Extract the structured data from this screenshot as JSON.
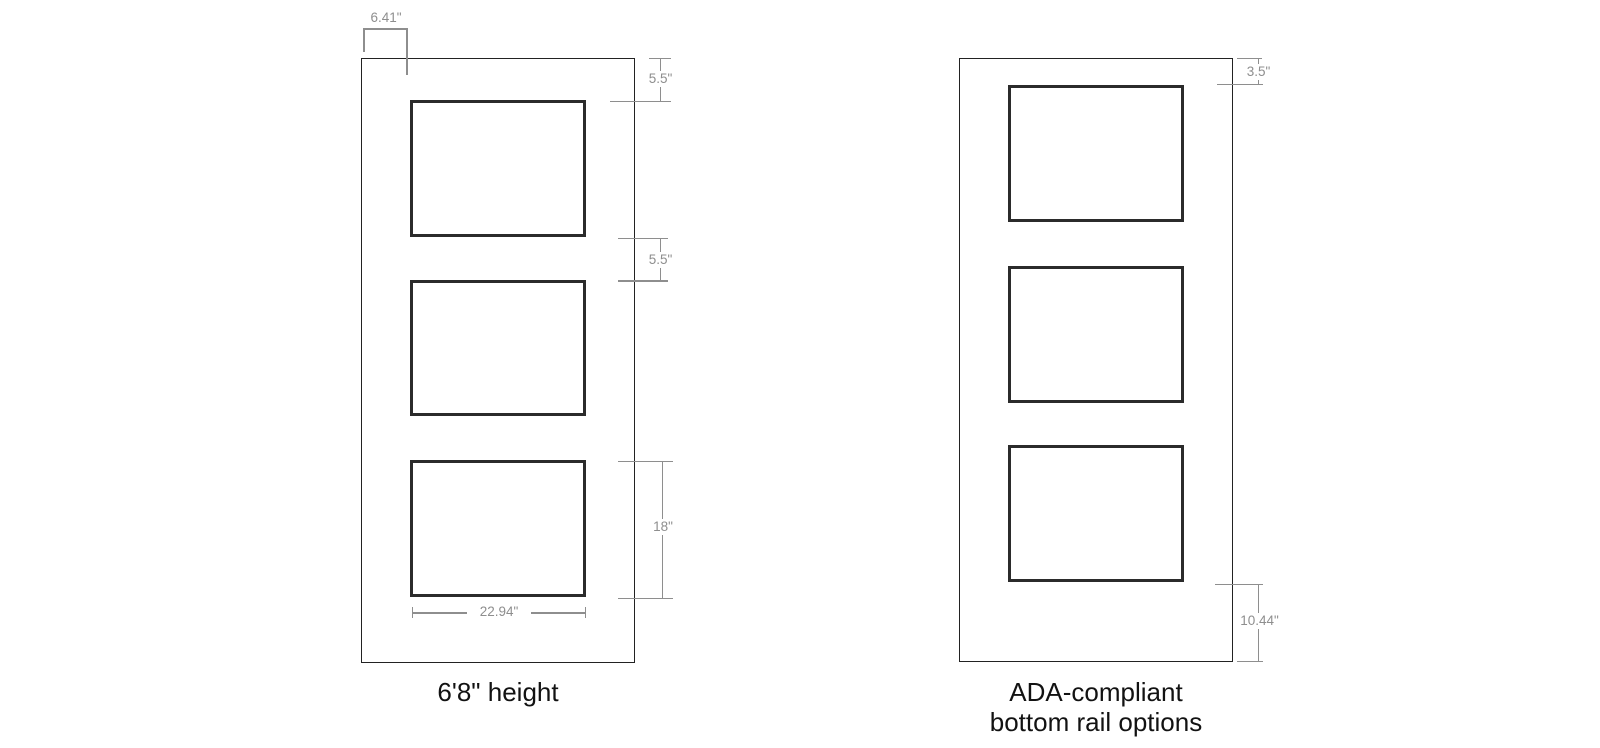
{
  "colors": {
    "background": "#ffffff",
    "door_line": "#222222",
    "panel_line": "#2b2b2b",
    "dimension_line": "#8e8e8e",
    "dimension_text": "#8e8e8e",
    "caption_text": "#121212"
  },
  "left_figure": {
    "caption": "6'8\" height",
    "dims": {
      "stile_width": "6.41\"",
      "top_rail": "5.5\"",
      "mid_rail": "5.5\"",
      "panel_height": "18\"",
      "panel_width": "22.94\""
    }
  },
  "right_figure": {
    "caption_line1": "ADA-compliant",
    "caption_line2": "bottom rail options",
    "dims": {
      "top_rail": "3.5\"",
      "bottom_rail": "10.44\""
    }
  }
}
